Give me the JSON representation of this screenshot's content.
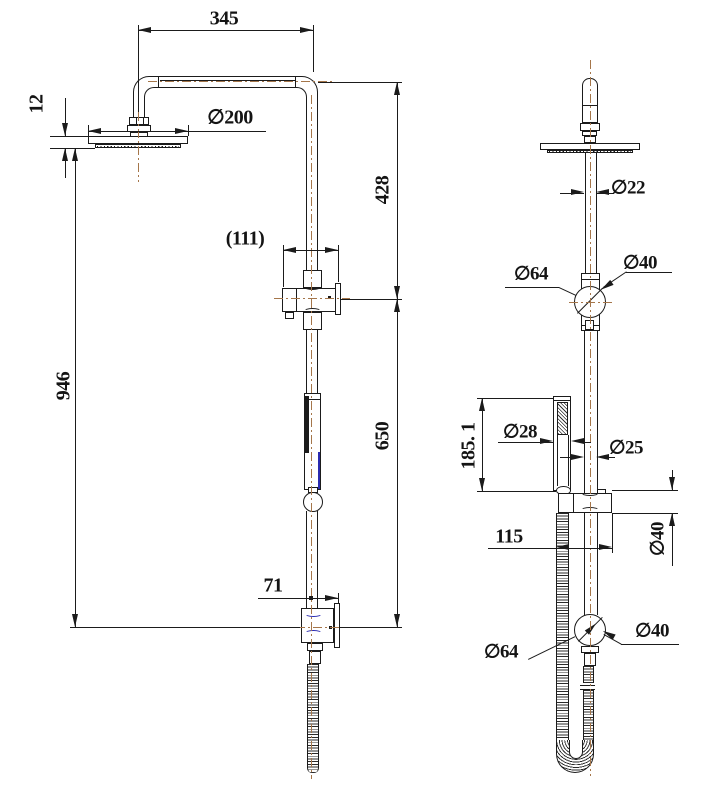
{
  "document": {
    "type": "technical-dimension-drawing",
    "subject": "shower column with overhead rain shower and hand shower, front and side views"
  },
  "dimensions": {
    "front": {
      "arm_span": "345",
      "head_thickness": "12",
      "head_diameter": "∅200",
      "diverter_width": "(111)",
      "upper_run": "428",
      "overall_height": "946",
      "lower_run": "650",
      "bottom_offset": "71"
    },
    "side": {
      "pipe_upper_diameter": "∅22",
      "diverter_flange_diameter": "∅64",
      "diverter_body_diameter": "∅40",
      "handset_length": "185. 1",
      "handset_diameter": "∅28",
      "pipe_lower_diameter": "∅25",
      "bracket_diameter": "∅40",
      "bracket_offset": "115",
      "elbow_flange_diameter": "∅64",
      "elbow_body_diameter": "∅40"
    }
  },
  "colors": {
    "line": "#1b1b1b",
    "centerline": "#a5764a",
    "accent_blue": "#2b2bb0",
    "background": "#ffffff"
  }
}
